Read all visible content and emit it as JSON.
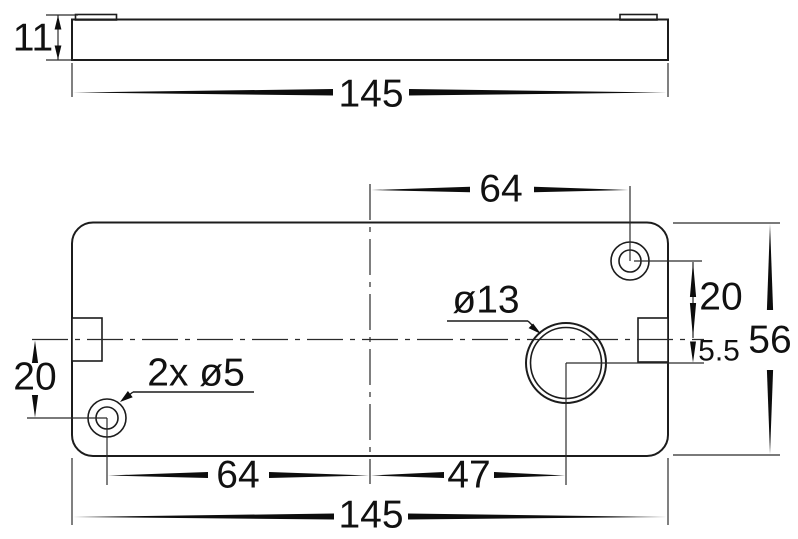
{
  "drawing": {
    "background_color": "#ffffff",
    "line_color": "#1c1c1c",
    "text_color": "#111111",
    "side_view": {
      "thickness_dim": "11",
      "width_dim": "145"
    },
    "plan_view": {
      "top_width_dim": "64",
      "right_hole_offset_dim": "20",
      "center_offset_dim": "5.5",
      "height_dim": "56",
      "large_hole_dim": "ø13",
      "small_holes_dim": "2x ø5",
      "left_hole_offset_dim": "20",
      "bottom_left_width_dim": "64",
      "bottom_center_width_dim": "47",
      "overall_width_dim": "145"
    }
  }
}
